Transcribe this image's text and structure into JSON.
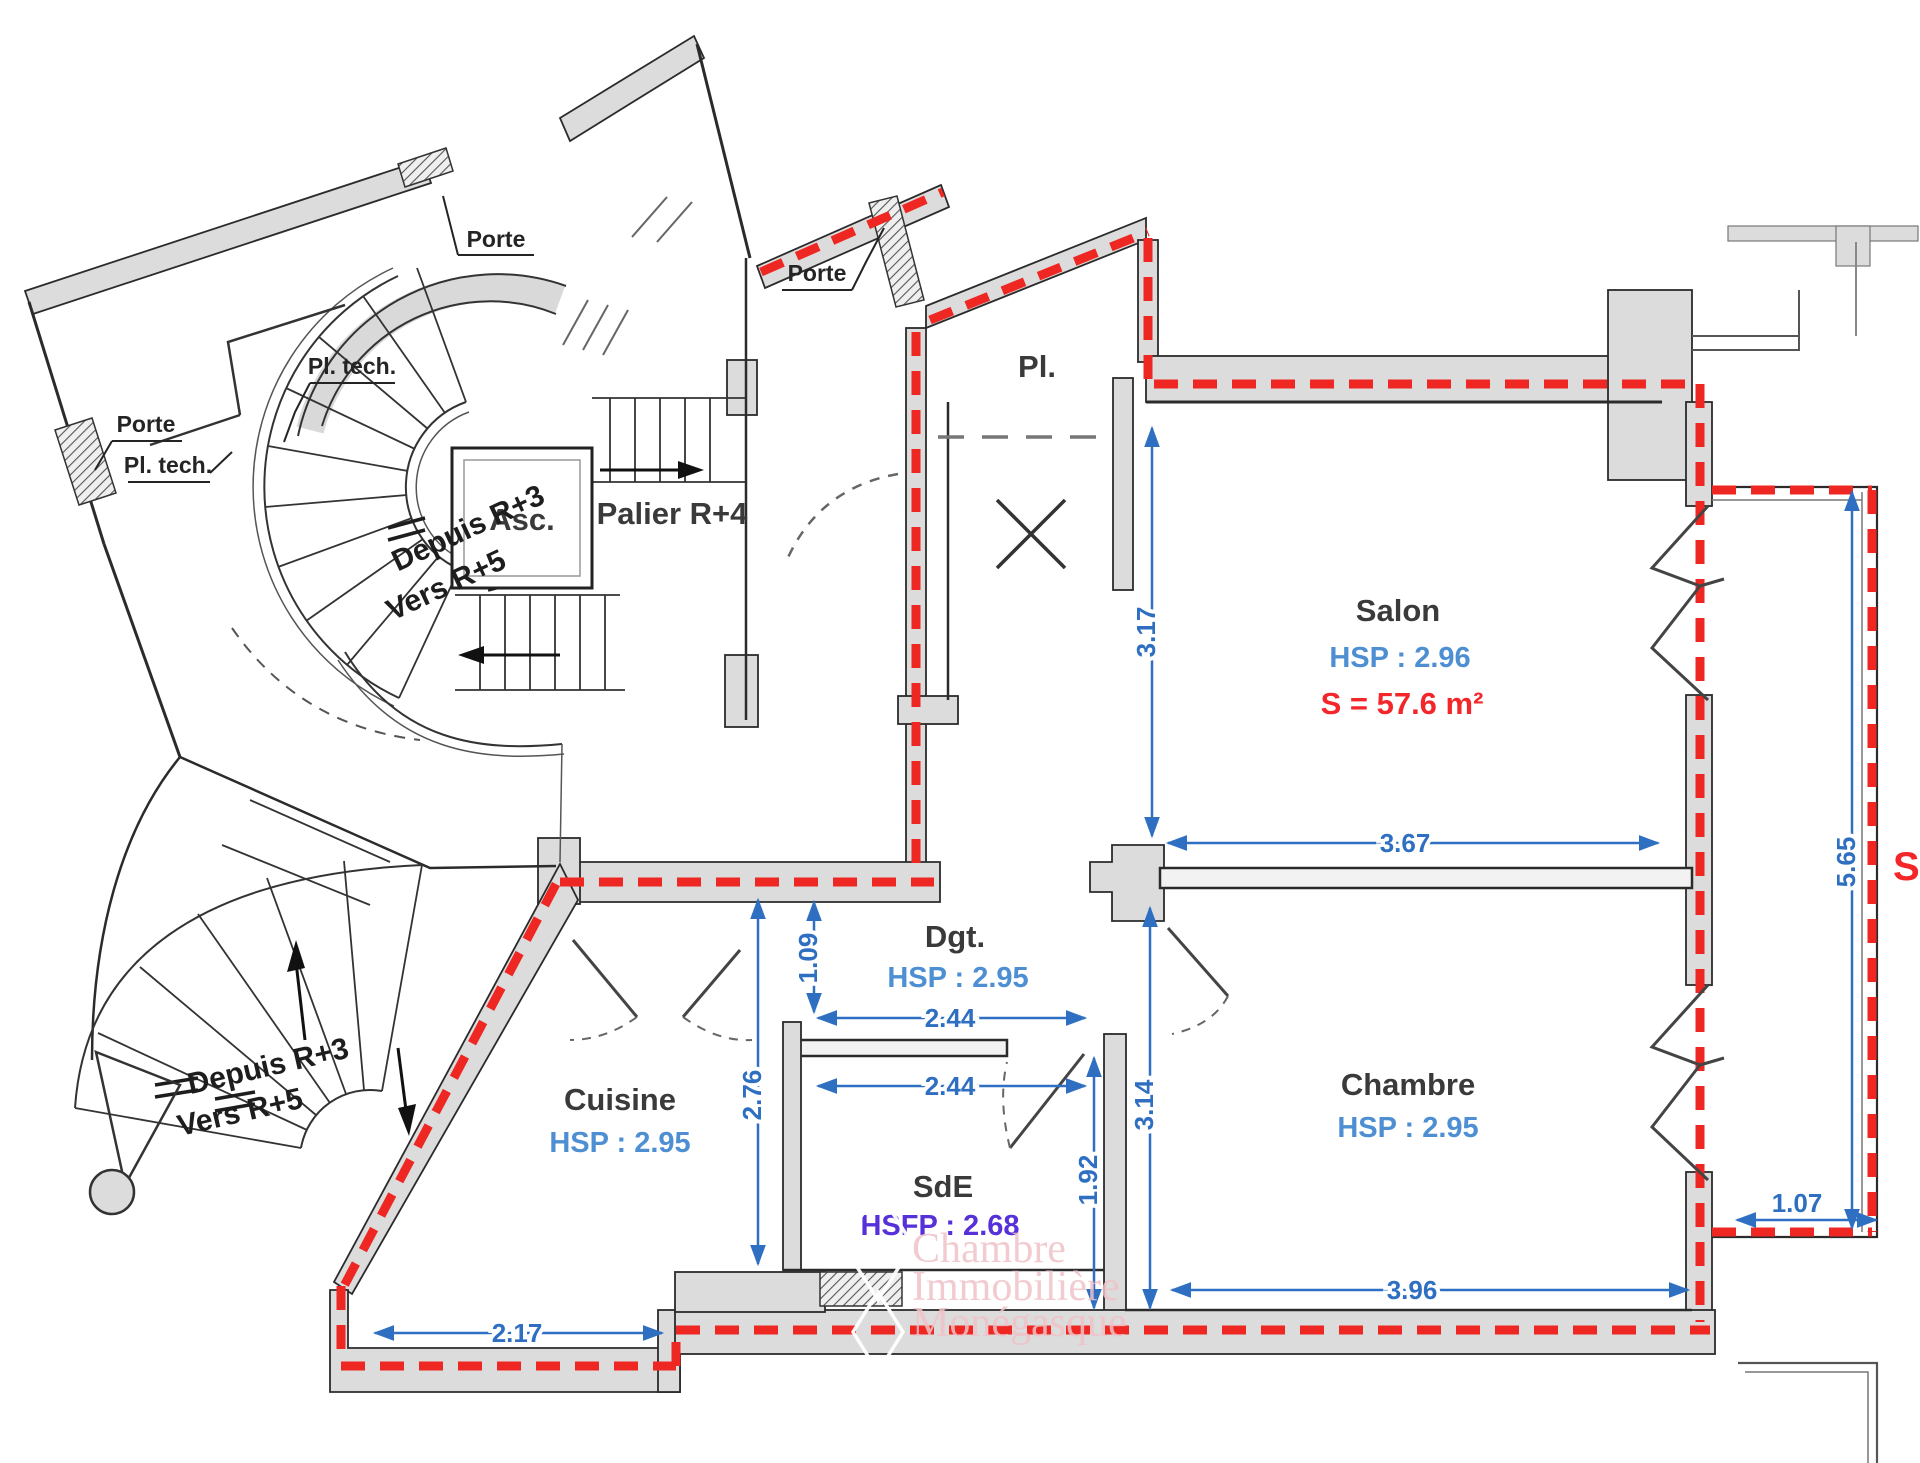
{
  "colors": {
    "wall_grey": "#dcdcdc",
    "perimeter_red": "#ee2722",
    "dim_blue": "#2f6fc1",
    "hsp_blue": "#4d8fd2",
    "area_red": "#f3262a",
    "hsfp_purple": "#5630d8",
    "watermark_pink": "#efc3c7"
  },
  "rooms": {
    "palier": {
      "name": "Palier R+4"
    },
    "asc": {
      "name": "Asc."
    },
    "pl": {
      "name": "Pl."
    },
    "salon": {
      "name": "Salon",
      "height": "HSP : 2.96",
      "area": "S = 57.6 m²"
    },
    "dgt": {
      "name": "Dgt.",
      "height": "HSP : 2.95"
    },
    "cuisine": {
      "name": "Cuisine",
      "height": "HSP : 2.95"
    },
    "sde": {
      "name": "SdE",
      "height": "HSFP : 2.68"
    },
    "chambre": {
      "name": "Chambre",
      "height": "HSP : 2.95"
    }
  },
  "labels": {
    "porte_a": "Porte",
    "porte_b": "Porte",
    "porte_c": "Porte",
    "pl_tech_a": "Pl. tech.",
    "pl_tech_b": "Pl. tech."
  },
  "stairs": {
    "upper_from": "Depuis R+3",
    "upper_to": "Vers R+5",
    "lower_from": "Depuis R+3",
    "lower_to": "Vers R+5"
  },
  "dimensions": {
    "entry_to_wall": "3.17",
    "salon_wall": "3.67",
    "dgt_offset": "1.09",
    "dgt_width": "2.44",
    "sde_width": "2.44",
    "cuisine_height": "2.76",
    "chambre_height": "3.14",
    "sde_height": "1.92",
    "kitchen_bottom": "2.17",
    "chambre_width": "3.96",
    "balcony_height": "5.65",
    "balcony_width": "1.07",
    "balcony_area_partial": "S"
  },
  "watermark": {
    "line1": "Chambre",
    "line2": "Immobilière",
    "line3": "Monégasque"
  }
}
